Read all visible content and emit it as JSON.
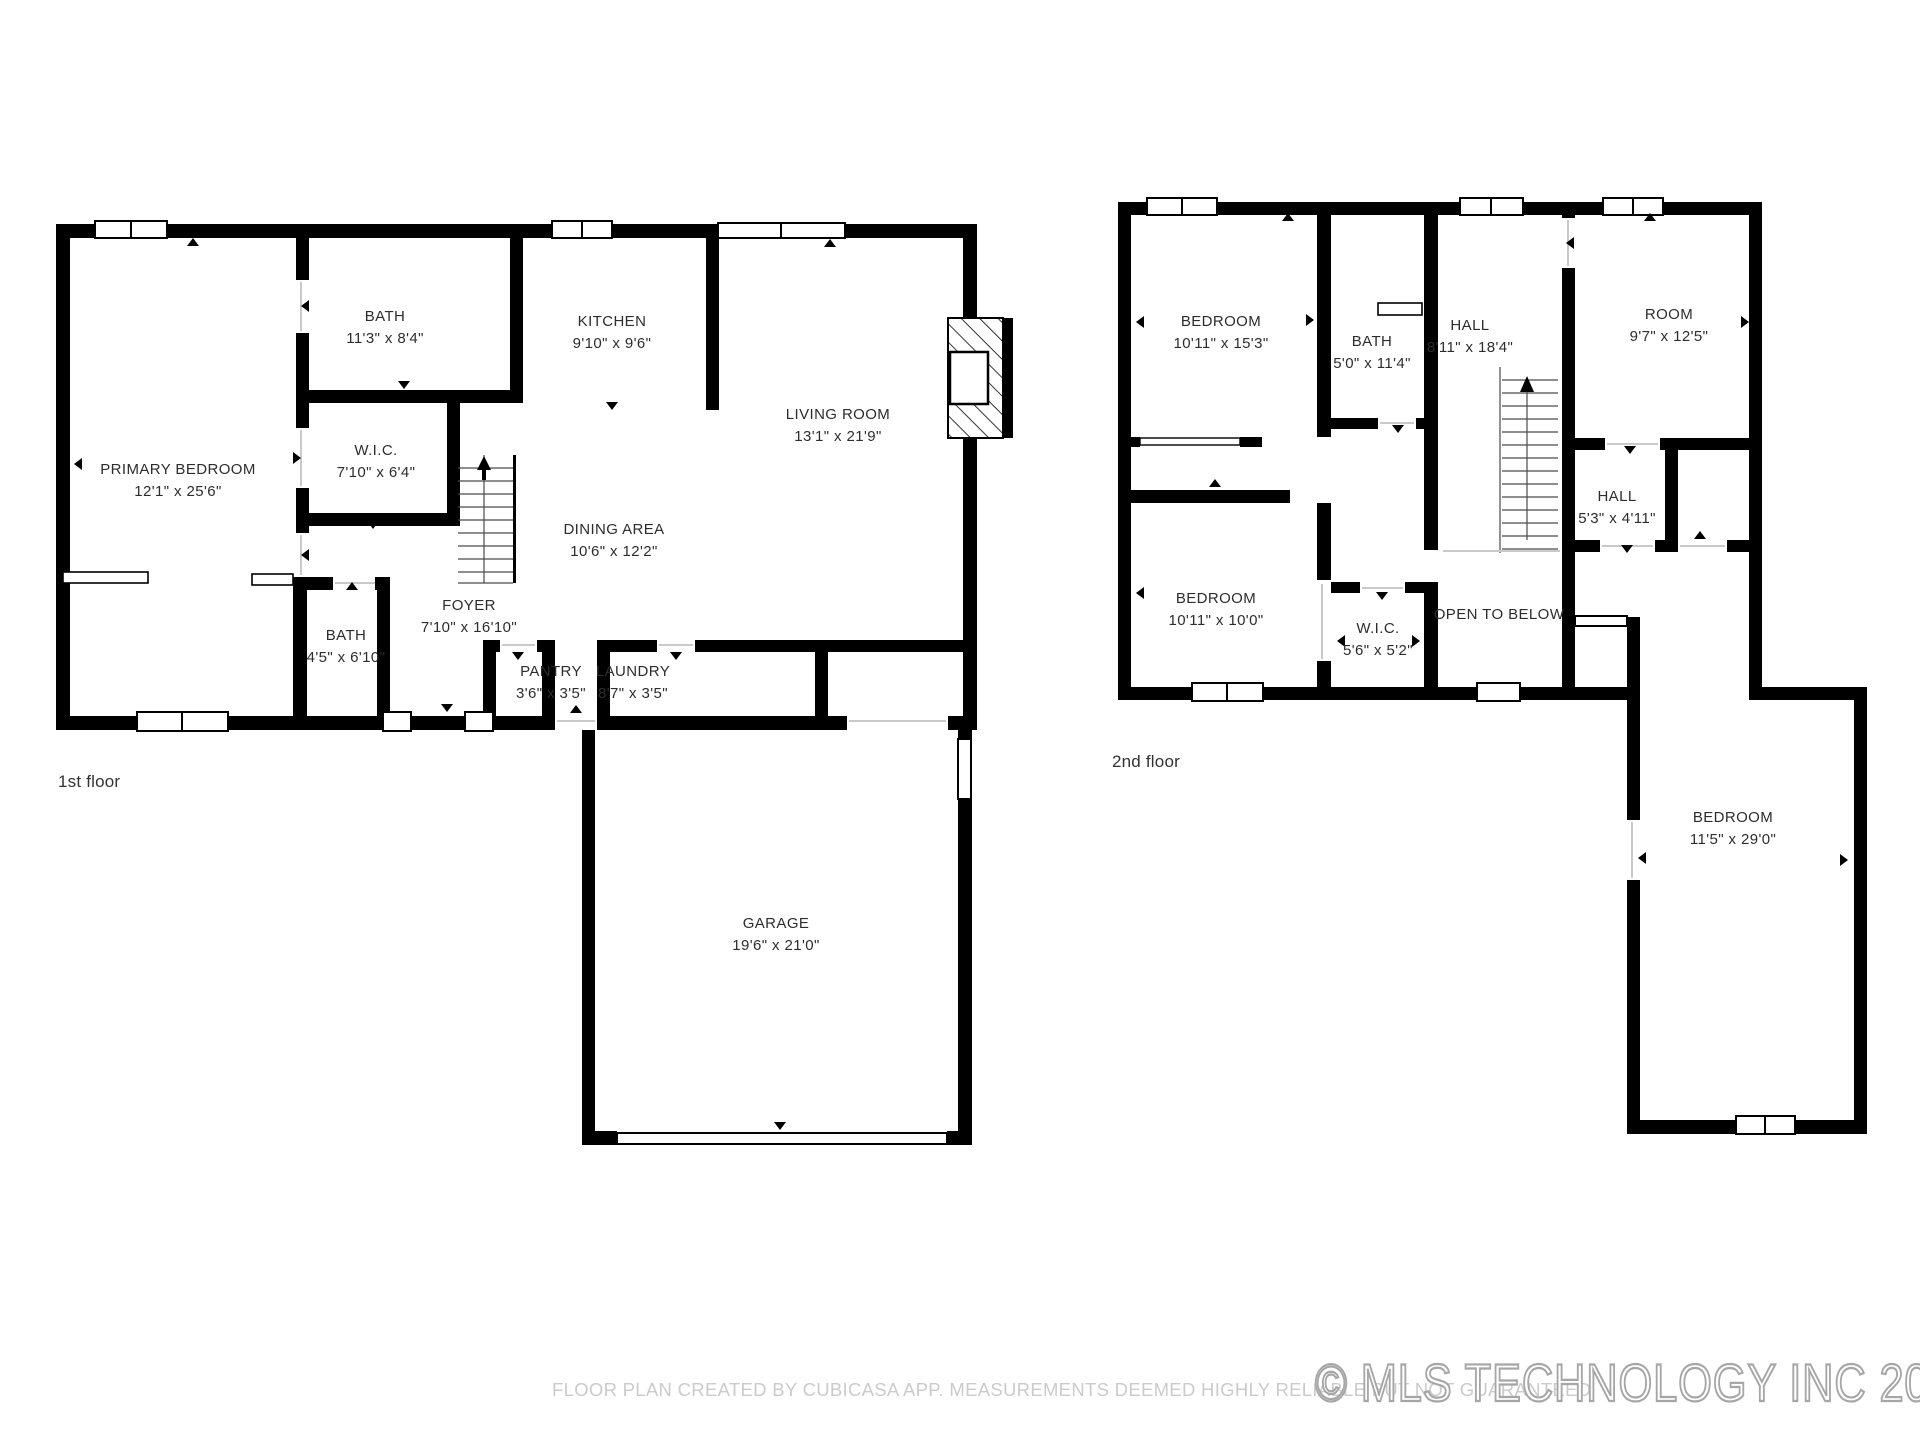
{
  "floors": [
    {
      "label": "1st floor",
      "rooms": [
        {
          "name": "PRIMARY BEDROOM",
          "dims": "12'1\" x 25'6\""
        },
        {
          "name": "BATH",
          "dims": "11'3\" x 8'4\""
        },
        {
          "name": "W.I.C.",
          "dims": "7'10\" x 6'4\""
        },
        {
          "name": "KITCHEN",
          "dims": "9'10\" x 9'6\""
        },
        {
          "name": "LIVING ROOM",
          "dims": "13'1\" x 21'9\""
        },
        {
          "name": "DINING AREA",
          "dims": "10'6\" x 12'2\""
        },
        {
          "name": "FOYER",
          "dims": "7'10\" x 16'10\""
        },
        {
          "name": "BATH",
          "dims": "4'5\" x 6'10\""
        },
        {
          "name": "PANTRY",
          "dims": "3'6\" x 3'5\""
        },
        {
          "name": "LAUNDRY",
          "dims": "8'7\" x 3'5\""
        },
        {
          "name": "GARAGE",
          "dims": "19'6\" x 21'0\""
        }
      ]
    },
    {
      "label": "2nd floor",
      "rooms": [
        {
          "name": "BEDROOM",
          "dims": "10'11\" x 15'3\""
        },
        {
          "name": "BATH",
          "dims": "5'0\" x 11'4\""
        },
        {
          "name": "HALL",
          "dims": "8'11\" x 18'4\""
        },
        {
          "name": "ROOM",
          "dims": "9'7\" x 12'5\""
        },
        {
          "name": "HALL",
          "dims": "5'3\" x 4'11\""
        },
        {
          "name": "BEDROOM",
          "dims": "10'11\" x 10'0\""
        },
        {
          "name": "W.I.C.",
          "dims": "5'6\" x 5'2\""
        },
        {
          "name": "OPEN TO BELOW",
          "dims": ""
        },
        {
          "name": "BEDROOM",
          "dims": "11'5\" x 29'0\""
        }
      ]
    }
  ],
  "footer": {
    "disclaimer": "FLOOR PLAN CREATED BY CUBICASA APP. MEASUREMENTS DEEMED HIGHLY RELIABLE BUT NOT GUARANTEED",
    "copyright": "© MLS TECHNOLOGY INC 2025"
  },
  "colors": {
    "wall": "#000000",
    "label": "#2d2d2d",
    "muted": "#cbcbcb",
    "watermark": "#a6a6a6"
  }
}
